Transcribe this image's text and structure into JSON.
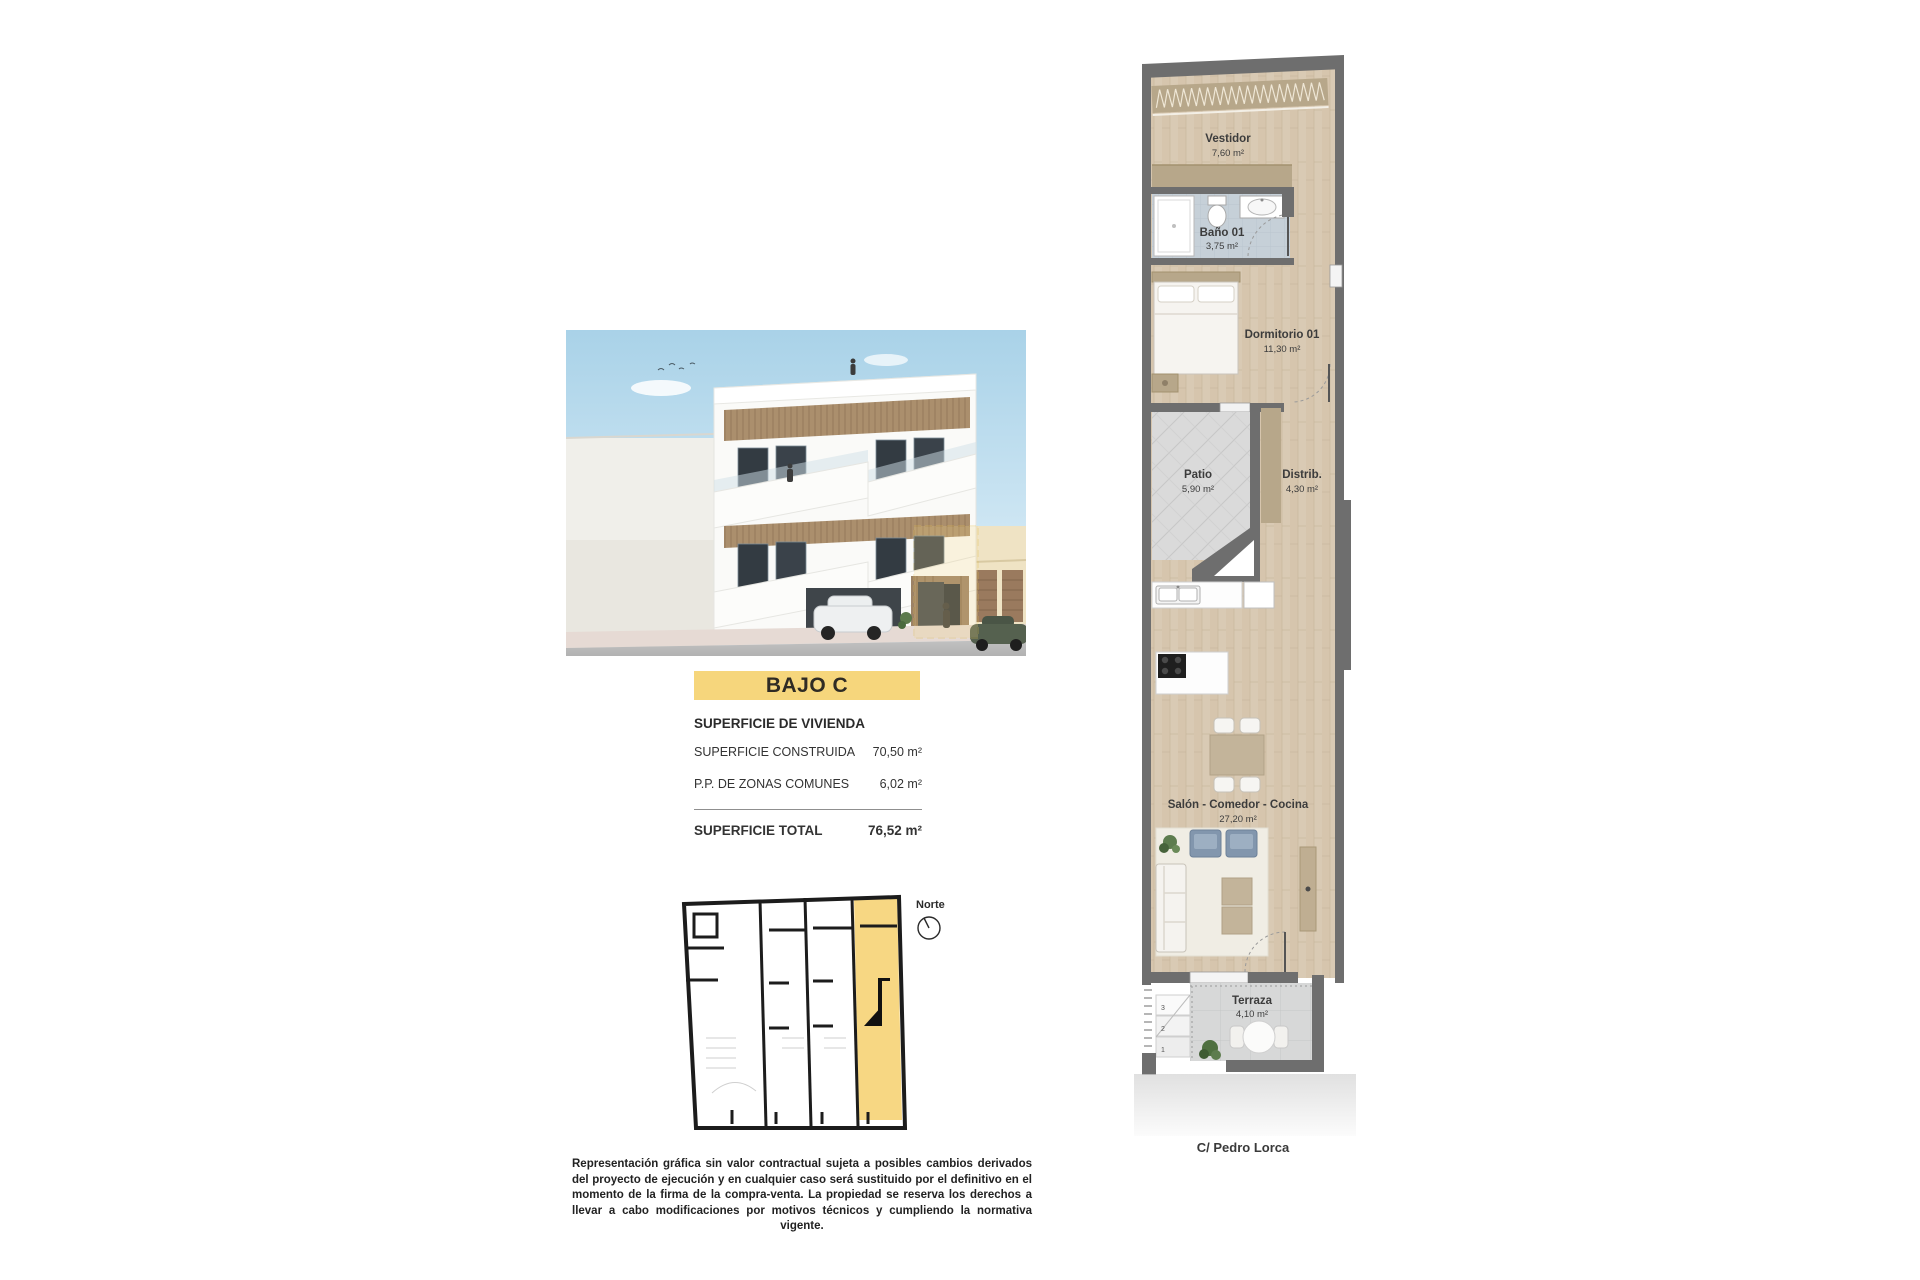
{
  "unit": {
    "title": "BAJO C"
  },
  "surface_table": {
    "header": "SUPERFICIE DE VIVIENDA",
    "rows": [
      {
        "label": "SUPERFICIE CONSTRUIDA",
        "value": "70,50 m²"
      },
      {
        "label": "P.P. DE ZONAS COMUNES",
        "value": "6,02 m²"
      }
    ],
    "total_label": "SUPERFICIE TOTAL",
    "total_value": "76,52 m²"
  },
  "key_plan": {
    "north_label": "Norte"
  },
  "floor_plan": {
    "rooms": {
      "vestidor": {
        "name": "Vestidor",
        "area": "7,60 m²"
      },
      "bano": {
        "name": "Baño 01",
        "area": "3,75 m²"
      },
      "dormitorio": {
        "name": "Dormitorio 01",
        "area": "11,30 m²"
      },
      "patio": {
        "name": "Patio",
        "area": "5,90 m²"
      },
      "distrib": {
        "name": "Distrib.",
        "area": "4,30 m²"
      },
      "salon": {
        "name": "Salón - Comedor - Cocina",
        "area": "27,20 m²"
      },
      "terraza": {
        "name": "Terraza",
        "area": "4,10 m²"
      }
    },
    "steps": [
      "1",
      "2",
      "3"
    ],
    "street": "C/ Pedro Lorca"
  },
  "disclaimer": "Representación gráfica sin valor contractual sujeta a posibles cambios derivados del proyecto de ejecución y en cualquier caso será sustituido por el definitivo en el momento de la firma de la compra-venta. La propiedad se reserva los derechos a llevar a cabo modificaciones por motivos técnicos y cumpliendo la normativa vigente.",
  "colors": {
    "banner_yellow": "#f6d67c",
    "keyplan_highlight": "#f7d783",
    "wall_grey": "#6e6e6e",
    "wood_floor": "#d9cab4",
    "wardrobe_tan": "#b7a78a",
    "patio_tile": "#dadada",
    "bath_tile": "#c6d0d8",
    "armchair_blue": "#8296ad"
  }
}
